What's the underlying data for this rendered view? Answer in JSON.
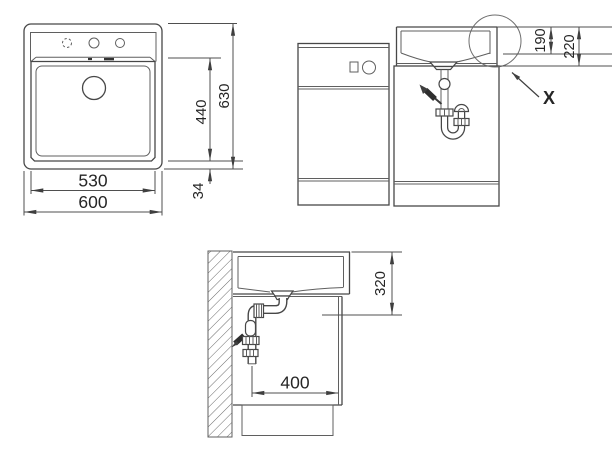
{
  "drawing_title": "Sink installation technical drawing",
  "plan_view": {
    "bowl_width": "530",
    "overall_width": "600",
    "bowl_length": "440",
    "overall_length": "630",
    "front_rim_width": "34"
  },
  "front_view": {
    "rim_to_bowl_floor": "190",
    "rim_to_worktop": "220",
    "detail_marker": "X"
  },
  "side_view": {
    "rim_to_drain_outlet": "320",
    "drain_clearance": "400"
  }
}
